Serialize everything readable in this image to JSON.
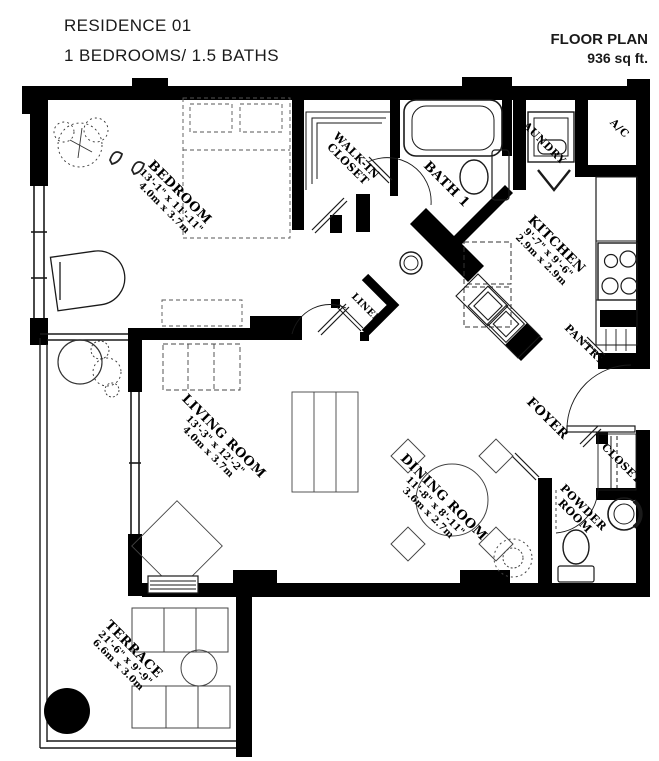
{
  "header": {
    "residence": "RESIDENCE 01",
    "subtitle": "1 BEDROOMS/ 1.5 BATHS",
    "plan_label": "FLOOR PLAN",
    "area": "936 sq ft."
  },
  "rooms": [
    {
      "name": "BEDROOM",
      "dims_ft": "13'-1\" x 11'-11\"",
      "dims_m": "4.0m x 3.7m"
    },
    {
      "name_lines": [
        "WALK-IN",
        "CLOSET"
      ]
    },
    {
      "name": "BATH 1"
    },
    {
      "name": "LAUNDRY"
    },
    {
      "name": "A/C"
    },
    {
      "name": "KITCHEN",
      "dims_ft": "9'-7\" x 9'-6\"",
      "dims_m": "2.9m x 2.9m"
    },
    {
      "name": "PANTRY"
    },
    {
      "name": "FOYER"
    },
    {
      "name": "LINEN"
    },
    {
      "name": "CLOSET"
    },
    {
      "name_lines": [
        "POWDER",
        "ROOM"
      ]
    },
    {
      "name": "LIVING ROOM",
      "dims_ft": "13'-3\" x 12'-2\"",
      "dims_m": "4.0m x 3.7m"
    },
    {
      "name": "DINING ROOM",
      "dims_ft": "11'-8\" x 8'-11\"",
      "dims_m": "3.6m x 2.7m"
    },
    {
      "name": "TERRACE",
      "dims_ft": "21'-6\" x 9'-9\"",
      "dims_m": "6.6m x 3.0m"
    }
  ],
  "colors": {
    "wall": "#000000",
    "sketch": "#444444",
    "background": "#ffffff"
  }
}
